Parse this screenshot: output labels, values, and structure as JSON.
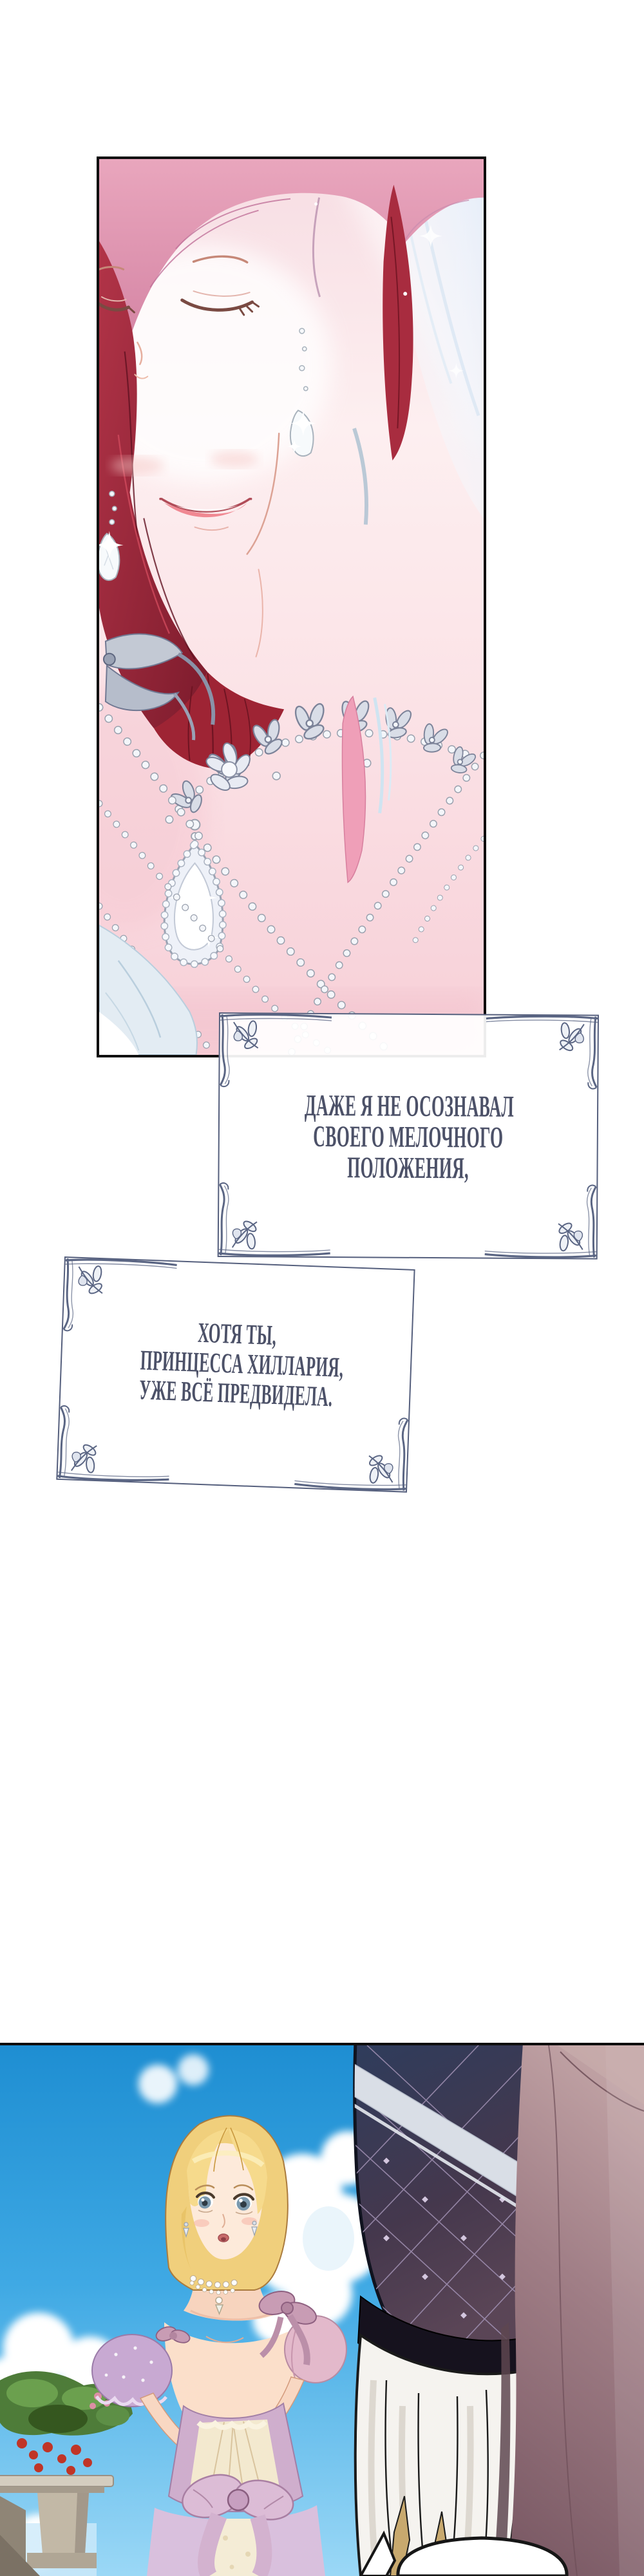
{
  "narration": {
    "box1": {
      "lines": [
        "ДАЖЕ Я НЕ ОСОЗНАВАЛ",
        "СВОЕГО МЕЛОЧНОГО",
        "ПОЛОЖЕНИЯ,"
      ]
    },
    "box2": {
      "lines": [
        "ХОТЯ ТЫ,",
        "ПРИНЦЕССА ХИЛЛАРИЯ,",
        "УЖЕ ВСЁ ПРЕДВИДЕЛА."
      ]
    }
  },
  "colors": {
    "page_bg": "#ffffff",
    "narration_text": "#4c5168",
    "narration_box_border": "#555f7d",
    "panel_border": "#0d0d0d",
    "sky_blue": "#2b9ddf",
    "hair_red": "#a22a3c",
    "hair_pink_top": "#e6a0ba",
    "hair_blonde": "#f0cf7c",
    "quilt_navy": "#32405c",
    "drape_mauve": "#a07e86",
    "dress_lavender": "#cfaecd",
    "bodice_cream": "#f3e9cf",
    "skin": "#fbe3d3"
  }
}
